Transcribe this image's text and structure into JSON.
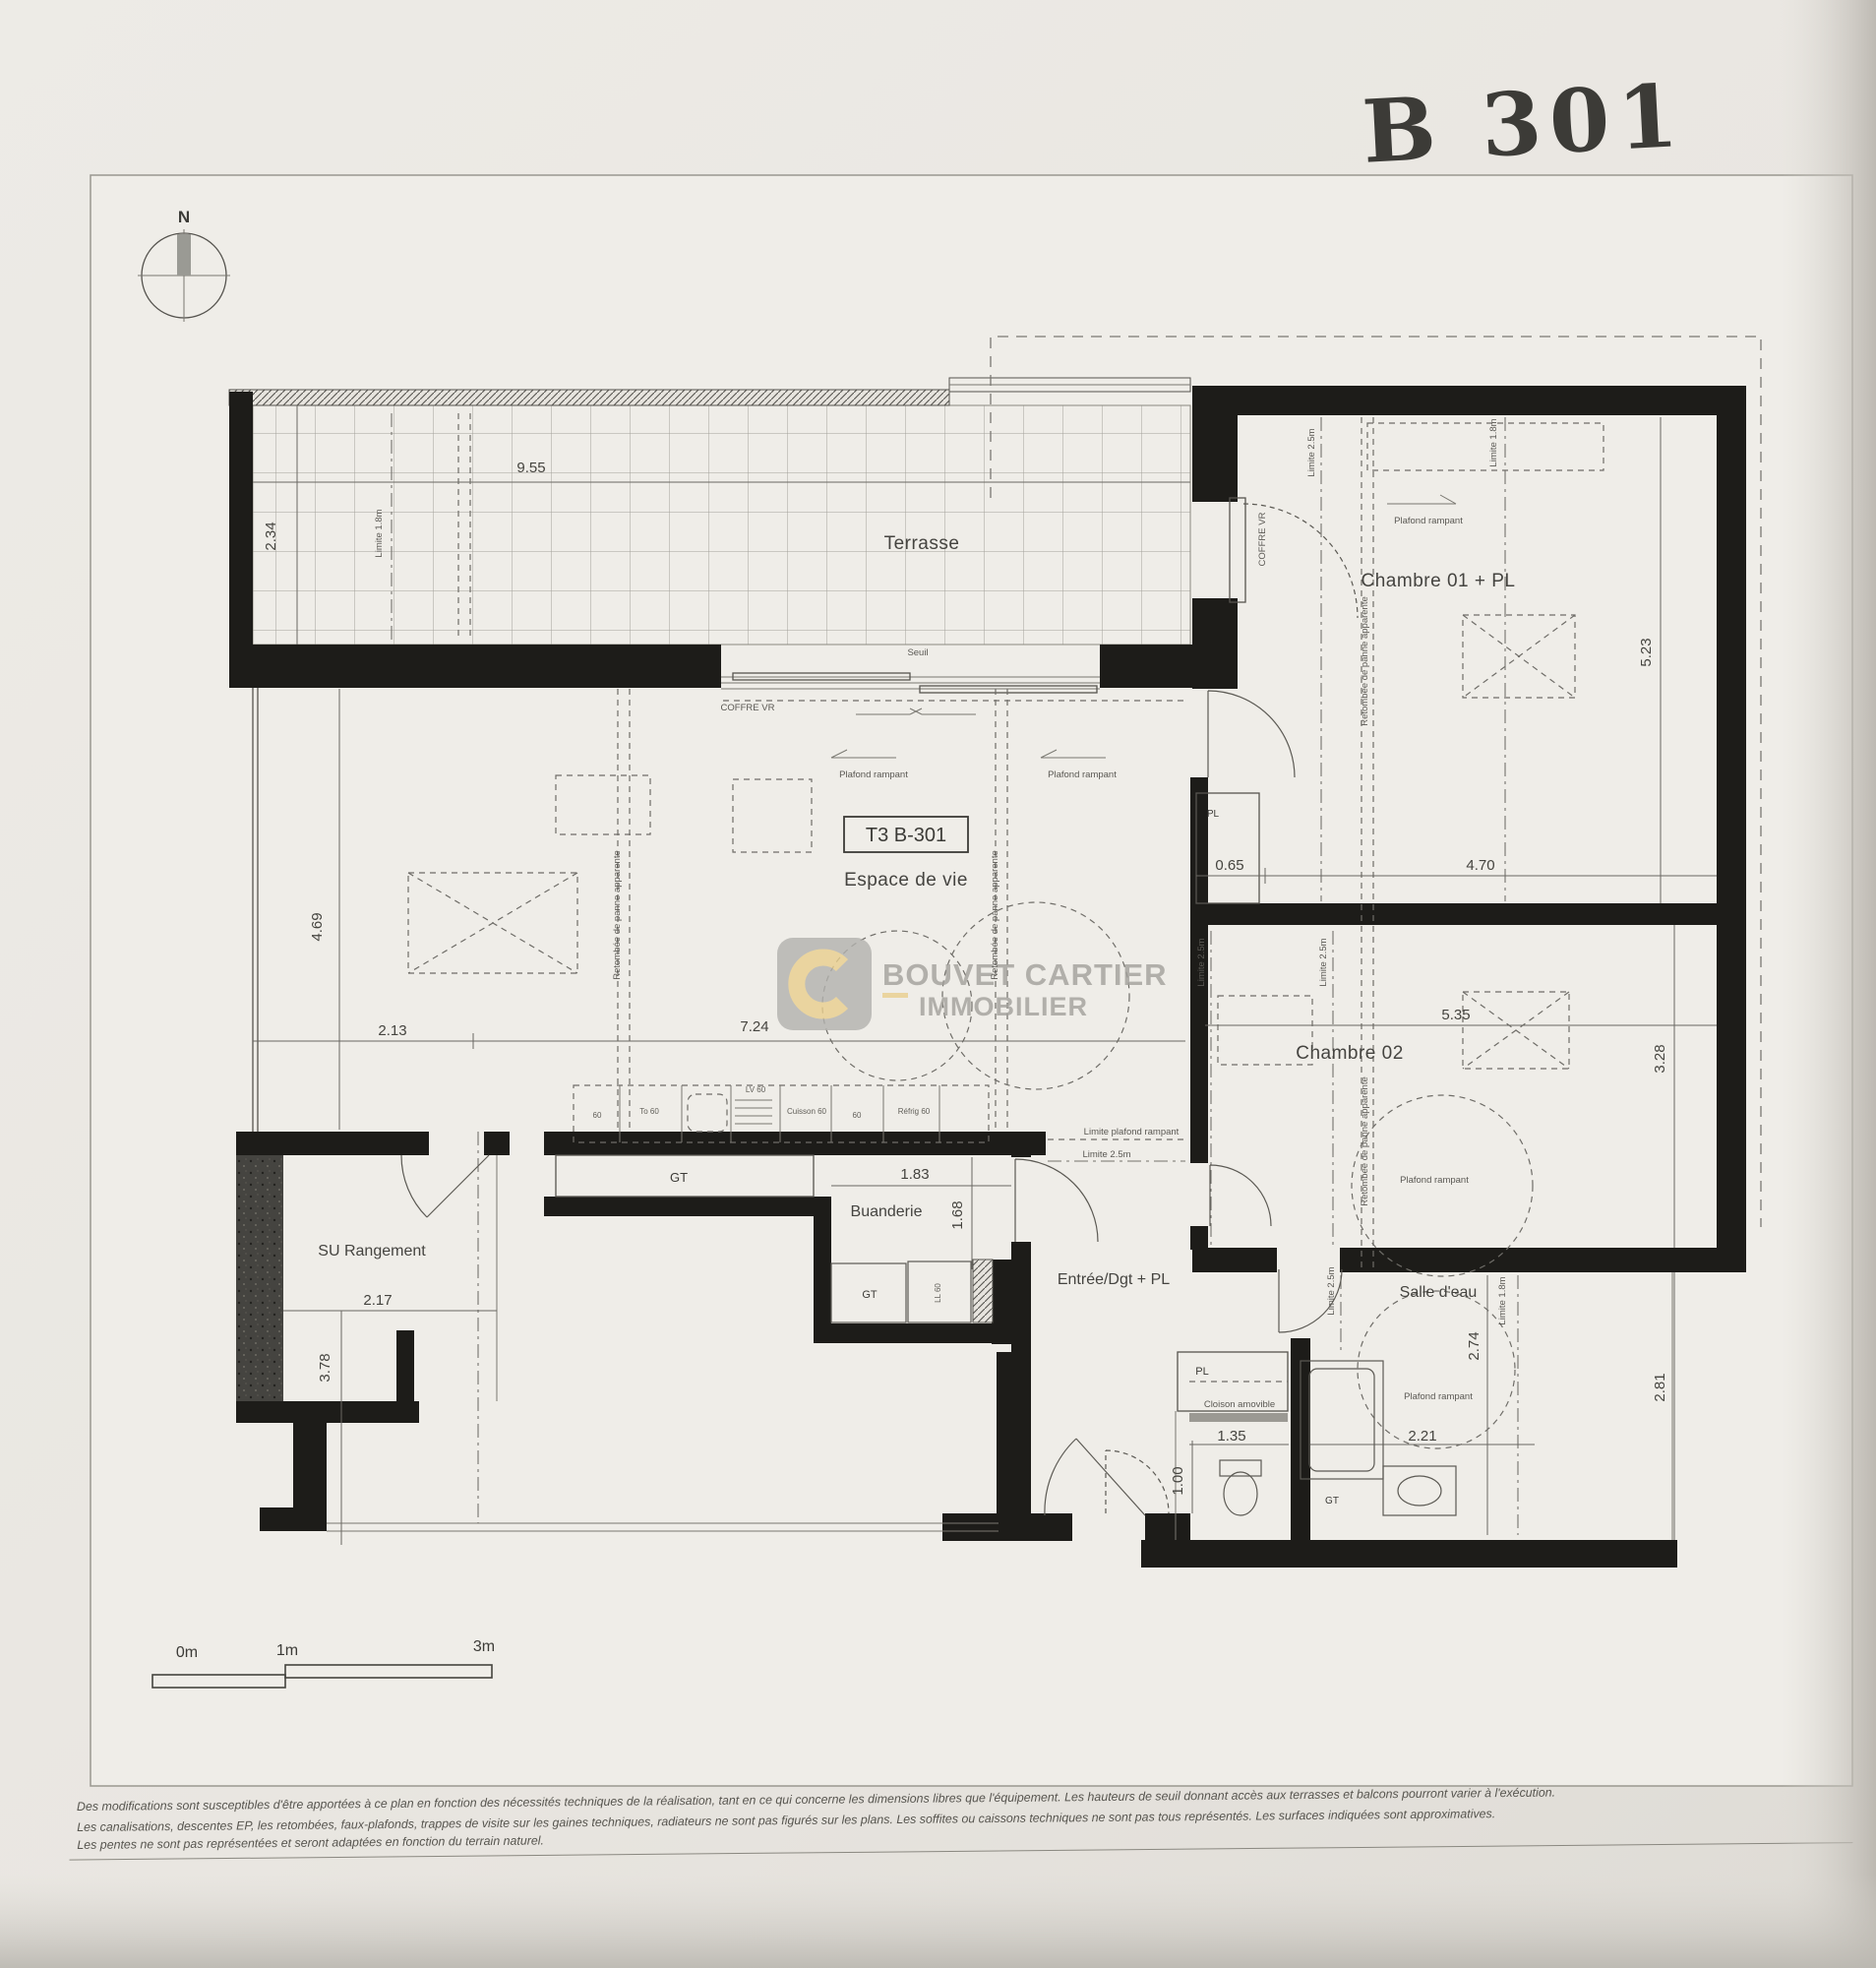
{
  "title": {
    "handwritten": "B 301"
  },
  "compass": {
    "n": "N"
  },
  "unit": "T3 B-301",
  "rooms": {
    "terrasse": "Terrasse",
    "chambre01": "Chambre 01 + PL",
    "chambre02": "Chambre 02",
    "espace": "Espace de vie",
    "buanderie": "Buanderie",
    "entree": "Entrée/Dgt + PL",
    "salle_eau": "Salle d'eau",
    "rangement": "SU Rangement"
  },
  "dims": {
    "terrace_w": "9.55",
    "terrace_d": "2.34",
    "ch1_h": "5.23",
    "ch1_w": "4.70",
    "pl_w": "0.65",
    "ch2_w": "5.35",
    "ch2_h": "3.28",
    "sde_zone_h": "2.81",
    "esp_l1": "2.13",
    "esp_l2": "7.24",
    "esp_h": "4.69",
    "bua_w": "1.83",
    "bua_h": "1.68",
    "su_w": "2.17",
    "su_h": "3.78",
    "wc_w": "1.35",
    "wc_h": "1.00",
    "sde_h": "2.74",
    "sde_w": "2.21"
  },
  "ann": {
    "plafond": "Plafond rampant",
    "lim25": "Limite 2.5m",
    "lim18": "Limite 1.8m",
    "lim_pr": "Limite plafond rampant",
    "retombee": "Retombée de panne apparente",
    "coffre": "COFFRE VR",
    "seuil": "Seuil",
    "cloison": "Cloison amovible",
    "gt": "GT",
    "pl": "PL",
    "ll": "LL 60"
  },
  "kitchen": {
    "k1": "60",
    "k2": "To 60",
    "k3": "LV 60",
    "k4": "Cuisson 60",
    "k5": "60",
    "k6": "Réfrig 60"
  },
  "watermark": {
    "line1": "BOUVET CARTIER",
    "line2": "IMMOBILIER",
    "accent": "#e9cf8e",
    "gray": "#a2a09b"
  },
  "scalebar": {
    "a": "0m",
    "b": "1m",
    "c": "3m"
  },
  "footer": {
    "l1": "Des modifications sont susceptibles d'être apportées à ce plan en fonction des nécessités techniques de la réalisation, tant en ce qui concerne les dimensions libres que l'équipement. Les hauteurs de seuil donnant accès aux terrasses et balcons pourront varier à l'exécution.",
    "l2": "Les canalisations, descentes EP, les retombées, faux-plafonds, trappes de visite sur les gaines techniques, radiateurs ne sont pas figurés sur les plans. Les soffites ou caissons techniques ne sont pas tous représentés. Les surfaces indiquées sont approximatives.",
    "l3": "Les pentes ne sont pas représentées et seront adaptées en fonction du terrain naturel."
  }
}
